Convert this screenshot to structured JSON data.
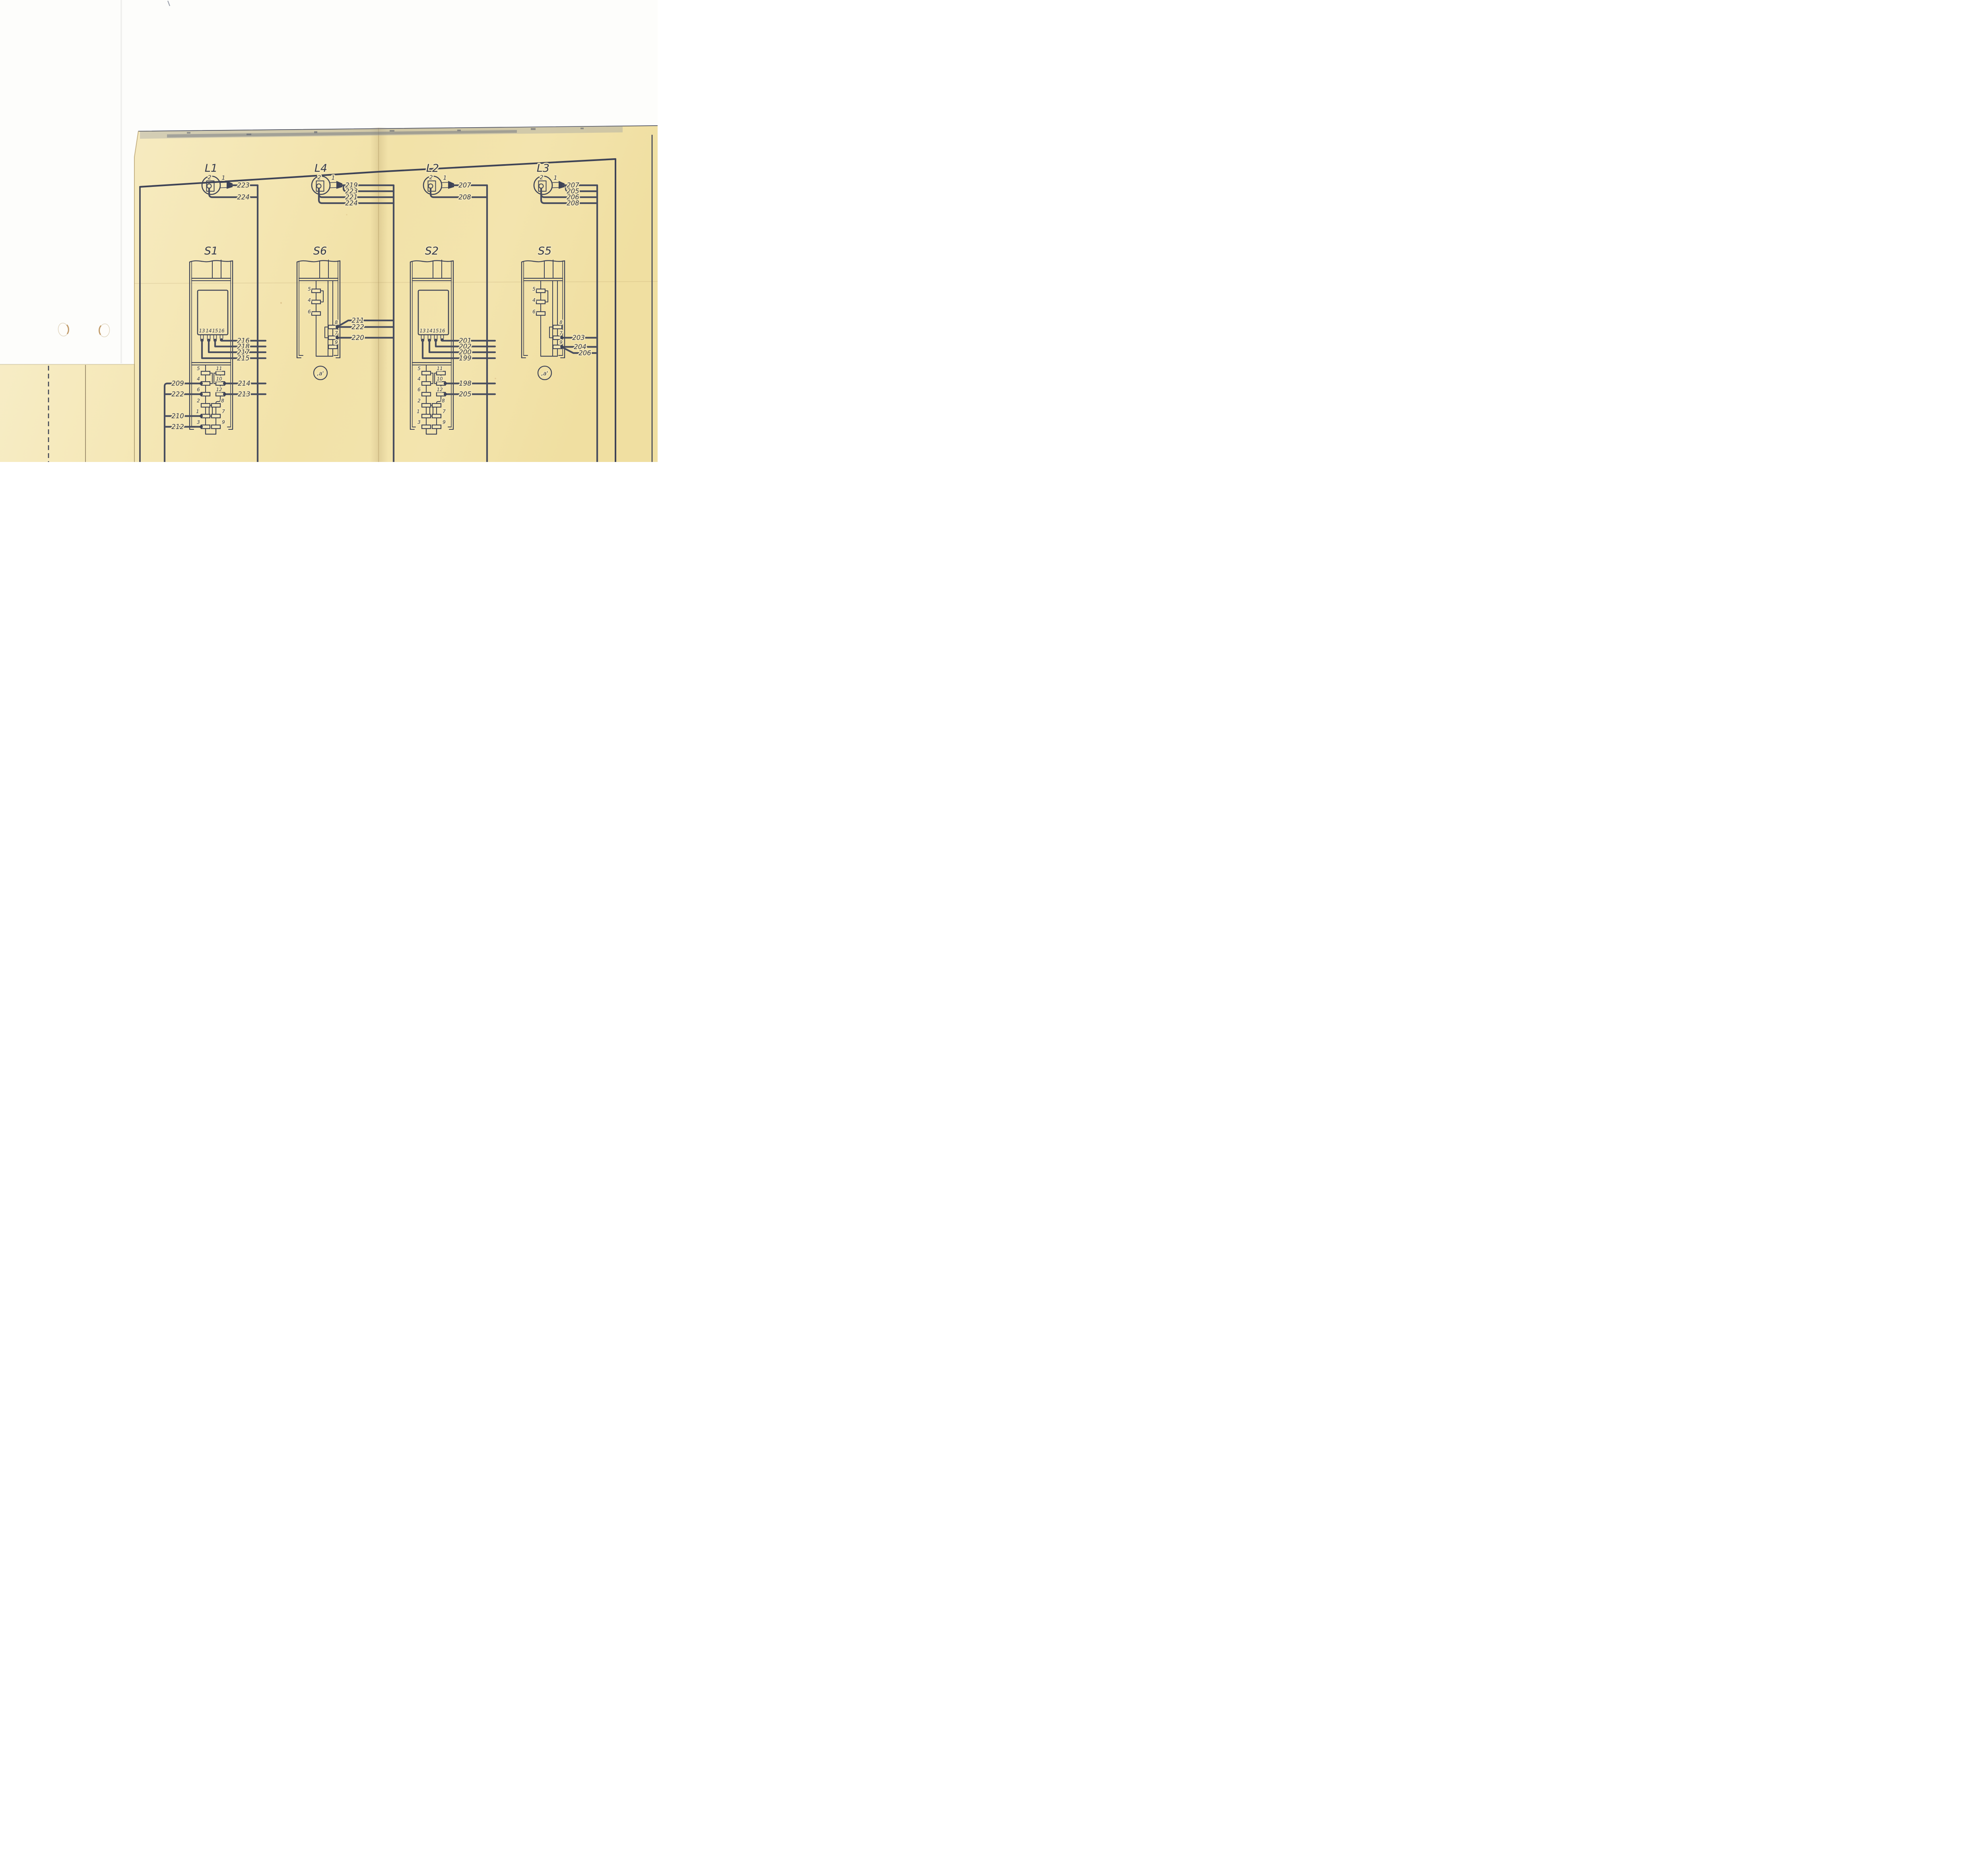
{
  "page": {
    "background": "#ffffff",
    "paper_color": "#f5e8ba",
    "ink_color": "#3e4356"
  },
  "lamps": [
    {
      "id": "L1",
      "label": "L1",
      "terminal_top": "2",
      "terminal_side": "1",
      "wires": [
        "223",
        "224"
      ]
    },
    {
      "id": "L4",
      "label": "L4",
      "terminal_top": "2",
      "terminal_side": "1",
      "wires": [
        "219",
        "223",
        "221",
        "224"
      ]
    },
    {
      "id": "L2",
      "label": "L2",
      "terminal_top": "2",
      "terminal_side": "1",
      "wires": [
        "207",
        "208"
      ]
    },
    {
      "id": "L3",
      "label": "L3",
      "terminal_top": "2",
      "terminal_side": "1",
      "wires": [
        "207",
        "205",
        "206",
        "208"
      ]
    }
  ],
  "switches": [
    {
      "id": "S1",
      "label": "S1",
      "relay_pins": [
        "13",
        "14",
        "15",
        "16"
      ],
      "relay_wires": [
        "216",
        "218",
        "217",
        "215"
      ],
      "mid_left_pins": [
        "5",
        "4",
        "6"
      ],
      "mid_right_pins": [
        "11",
        "10",
        "12"
      ],
      "left_wires": [
        "209",
        "222"
      ],
      "mid_right_wires": [
        "214",
        "213"
      ],
      "bottom_left_pins": [
        "2",
        "1",
        "3"
      ],
      "bottom_left_wires": [
        "210",
        "212"
      ],
      "bottom_right_pins": [
        "8",
        "7",
        "9"
      ]
    },
    {
      "id": "S6",
      "label": "S6",
      "left_pins": [
        "5",
        "4",
        "6"
      ],
      "right_pins": [
        "8",
        "7",
        "9"
      ],
      "right_wires": [
        "211",
        "222",
        "220"
      ],
      "tag": ",a'"
    },
    {
      "id": "S2",
      "label": "S2",
      "relay_pins": [
        "13",
        "14",
        "15",
        "16"
      ],
      "relay_wires": [
        "201",
        "202",
        "200",
        "199"
      ],
      "mid_left_pins": [
        "5",
        "4",
        "6"
      ],
      "mid_right_pins": [
        "11",
        "10",
        "12"
      ],
      "right_wires": [
        "198",
        "205"
      ],
      "bottom_left_pins": [
        "2",
        "1",
        "3"
      ],
      "bottom_right_pins": [
        "8",
        "7",
        "9"
      ]
    },
    {
      "id": "S5",
      "label": "S5",
      "left_pins": [
        "5",
        "4",
        "6"
      ],
      "right_pins": [
        "8",
        "7",
        "9"
      ],
      "right_wires": [
        "203",
        "204",
        "206"
      ],
      "tag": ",a'"
    }
  ]
}
